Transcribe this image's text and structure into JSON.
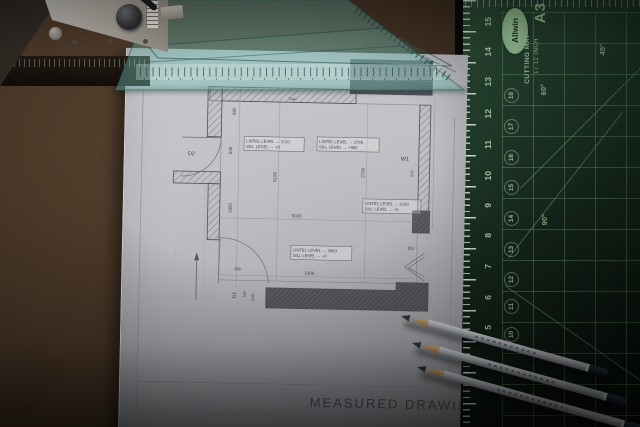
{
  "drawing": {
    "title": "MEASURED DRAWING",
    "labels": {
      "d1": "D1",
      "d2": "D2",
      "d3": "D3",
      "w1": "W1"
    },
    "annotations": [
      {
        "line1": "LINTEL LEVEL → 2110",
        "line2": "SILL LEVEL → +0"
      },
      {
        "line1": "LINTEL LEVEL → 2795",
        "line2": "SILL LEVEL → +965"
      },
      {
        "line1": "LINTEL LEVEL → 2100",
        "line2": "SILL LEVEL → +0"
      },
      {
        "line1": "LINTEL LEVEL → 2600",
        "line2": "SILL LEVEL → +0"
      }
    ],
    "dimensions": {
      "room_width": "5025",
      "bottom_opening": "1908",
      "top_width": "7040",
      "left_upper": "890",
      "left_mid": "645",
      "left_lower": "1950",
      "mid_height": "5185",
      "right_height": "2790",
      "window_len": "975",
      "door_sill": "888",
      "door_a": "995",
      "door_b": "1145"
    }
  },
  "mat": {
    "brand": "Allwin",
    "registered": "®",
    "product_line1": "CUTTING MAT",
    "product_line2": "17  11 INCH",
    "size_label": "A3",
    "edge_numbers": [
      "15",
      "14",
      "13",
      "12",
      "11",
      "10",
      "9",
      "8",
      "7",
      "6",
      "5"
    ],
    "circle_numbers": [
      "18",
      "17",
      "16",
      "15",
      "14",
      "13",
      "12",
      "11",
      "10"
    ],
    "angles": {
      "a45": "45°",
      "a60": "60°",
      "a90": "90°"
    }
  },
  "colors": {
    "mat_surface": "#1b2f23",
    "mat_grid": "#8cc896",
    "mat_text": "#cfe8cc",
    "teal_ruler": "#7ec8bd",
    "paper": "#c2c3c7",
    "desk_brown": "#4a3626",
    "pencil_body": "#b9bdc2",
    "pencil_cap": "#232e3c",
    "pencil_wood": "#c79a5e"
  }
}
